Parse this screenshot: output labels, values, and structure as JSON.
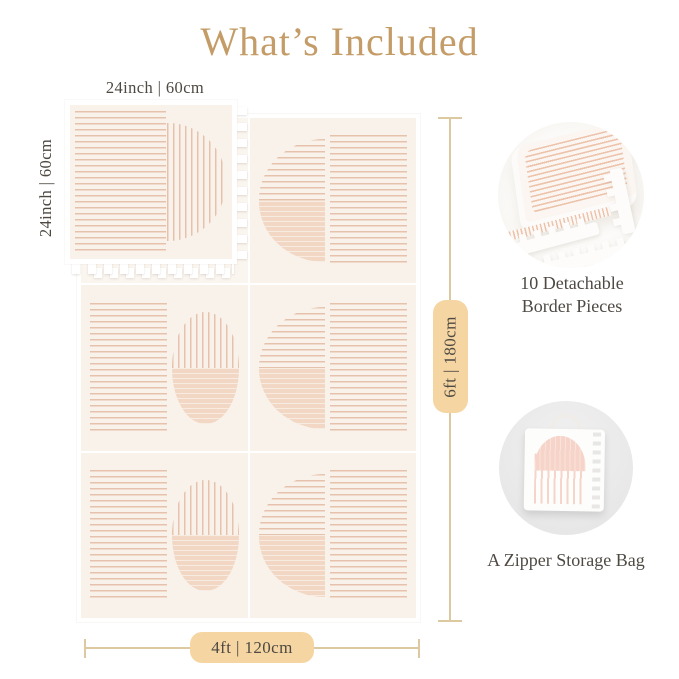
{
  "page": {
    "title": "What’s Included"
  },
  "diagram": {
    "tile": {
      "top_label": "24inch | 60cm",
      "side_label": "24inch | 60cm"
    },
    "mat": {
      "height_label": "6ft | 180cm",
      "width_label": "4ft | 120cm"
    }
  },
  "callouts": {
    "border_pieces": {
      "line1": "10 Detachable",
      "line2": "Border Pieces"
    },
    "storage_bag": {
      "label": "A Zipper Storage Bag"
    }
  },
  "colors": {
    "accent_gold": "#c49c67",
    "text_dark": "#4e4943",
    "pill_bg": "#f5d5a2",
    "measure_line": "#ddc9a0",
    "mat_cream": "#f8f2eb",
    "stripe_peach": "#e6c1ab",
    "stripe_dense": "#eec3ac",
    "wash_peach": "#f2d8c4",
    "bag_pink": "#f7d4c9"
  }
}
